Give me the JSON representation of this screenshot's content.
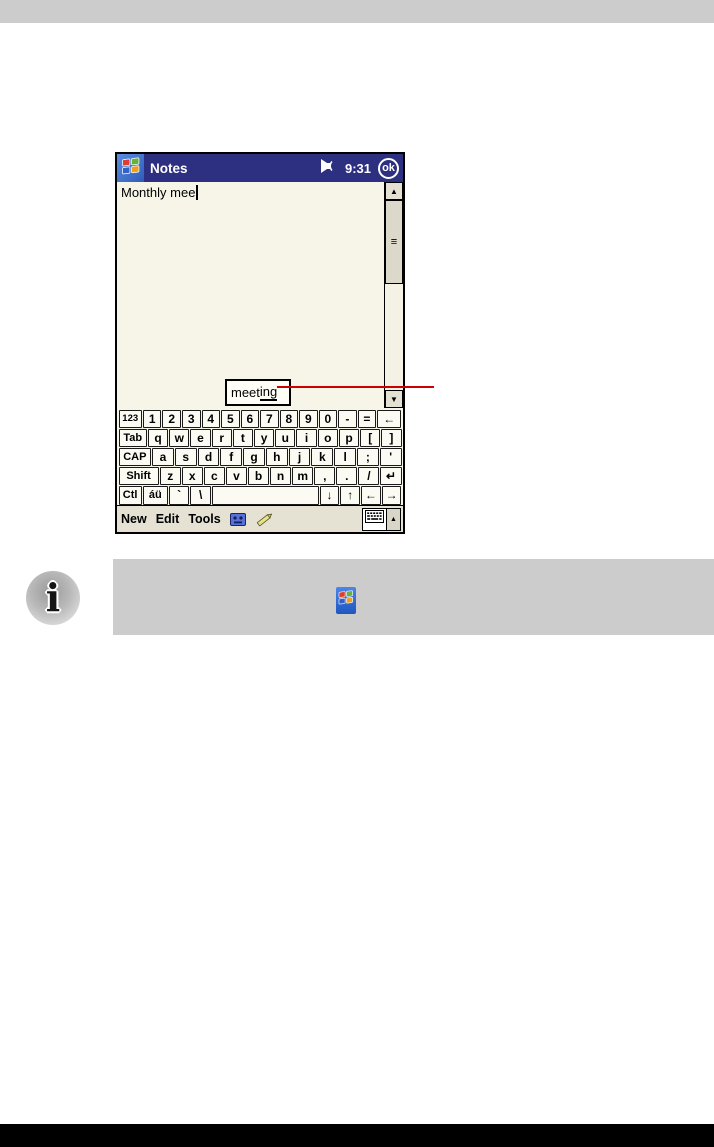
{
  "page": {
    "top_bar_color": "#cccccc",
    "bottom_bar_color": "#000000",
    "tip_box_color": "#cccccc",
    "red_line_color": "#cc0000",
    "info_icon_glyph": "i"
  },
  "device": {
    "titlebar": {
      "app_title": "Notes",
      "time": "9:31",
      "ok_label": "ok",
      "start_icon": "windows-flag-icon",
      "volume_icon": "speaker-icon"
    },
    "note": {
      "text": "Monthly mee"
    },
    "suggestion": {
      "prefix": "meet",
      "underlined": "ing",
      "full_word": "meeting"
    },
    "scrollbar": {
      "up_arrow": "▲",
      "down_arrow": "▼",
      "thumb_grip": "≡"
    },
    "keyboard": {
      "rows": [
        [
          {
            "label": "123",
            "w": 1.3,
            "cls": "tiny",
            "name": "123"
          },
          {
            "label": "1"
          },
          {
            "label": "2"
          },
          {
            "label": "3"
          },
          {
            "label": "4"
          },
          {
            "label": "5"
          },
          {
            "label": "6"
          },
          {
            "label": "7"
          },
          {
            "label": "8"
          },
          {
            "label": "9"
          },
          {
            "label": "0"
          },
          {
            "label": "-",
            "name": "minus"
          },
          {
            "label": "=",
            "name": "equals"
          },
          {
            "label": "←",
            "w": 1.35,
            "name": "backspace"
          }
        ],
        [
          {
            "label": "Tab",
            "w": 1.45,
            "cls": "mod",
            "name": "tab"
          },
          {
            "label": "q"
          },
          {
            "label": "w"
          },
          {
            "label": "e"
          },
          {
            "label": "r"
          },
          {
            "label": "t"
          },
          {
            "label": "y"
          },
          {
            "label": "u"
          },
          {
            "label": "i"
          },
          {
            "label": "o"
          },
          {
            "label": "p"
          },
          {
            "label": "[",
            "name": "bracket-left"
          },
          {
            "label": "]",
            "name": "bracket-right"
          }
        ],
        [
          {
            "label": "CAP",
            "w": 1.55,
            "cls": "mod",
            "name": "cap"
          },
          {
            "label": "a"
          },
          {
            "label": "s"
          },
          {
            "label": "d"
          },
          {
            "label": "f"
          },
          {
            "label": "g"
          },
          {
            "label": "h"
          },
          {
            "label": "j"
          },
          {
            "label": "k"
          },
          {
            "label": "l"
          },
          {
            "label": ";",
            "name": "semicolon"
          },
          {
            "label": "'",
            "name": "apostrophe"
          }
        ],
        [
          {
            "label": "Shift",
            "w": 2.0,
            "cls": "mod",
            "name": "shift"
          },
          {
            "label": "z"
          },
          {
            "label": "x"
          },
          {
            "label": "c"
          },
          {
            "label": "v"
          },
          {
            "label": "b"
          },
          {
            "label": "n"
          },
          {
            "label": "m"
          },
          {
            "label": ",",
            "name": "comma"
          },
          {
            "label": ".",
            "name": "period"
          },
          {
            "label": "/",
            "name": "slash"
          },
          {
            "label": "↵",
            "name": "enter"
          }
        ],
        [
          {
            "label": "Ctl",
            "w": 1.2,
            "cls": "mod",
            "name": "ctl"
          },
          {
            "label": "áü",
            "w": 1.3,
            "cls": "mod",
            "name": "accents"
          },
          {
            "label": "`",
            "w": 1.05,
            "name": "backtick"
          },
          {
            "label": "\\",
            "w": 1.05,
            "name": "backslash"
          },
          {
            "label": "",
            "w": 5.9,
            "name": "space"
          },
          {
            "label": "↓",
            "name": "arrow-down"
          },
          {
            "label": "↑",
            "name": "arrow-up"
          },
          {
            "label": "←",
            "name": "arrow-left"
          },
          {
            "label": "→",
            "name": "arrow-right"
          }
        ]
      ]
    },
    "menubar": {
      "items": [
        {
          "label": "New",
          "name": "menu-new"
        },
        {
          "label": "Edit",
          "name": "menu-edit"
        },
        {
          "label": "Tools",
          "name": "menu-tools"
        }
      ],
      "recording_icon": "recording-toolbar-icon",
      "pen_icon": "pen-icon",
      "input_panel_icon": "keyboard-icon",
      "input_panel_arrow": "▲"
    }
  },
  "tip": {
    "inline_icon": "windows-flag-icon"
  }
}
